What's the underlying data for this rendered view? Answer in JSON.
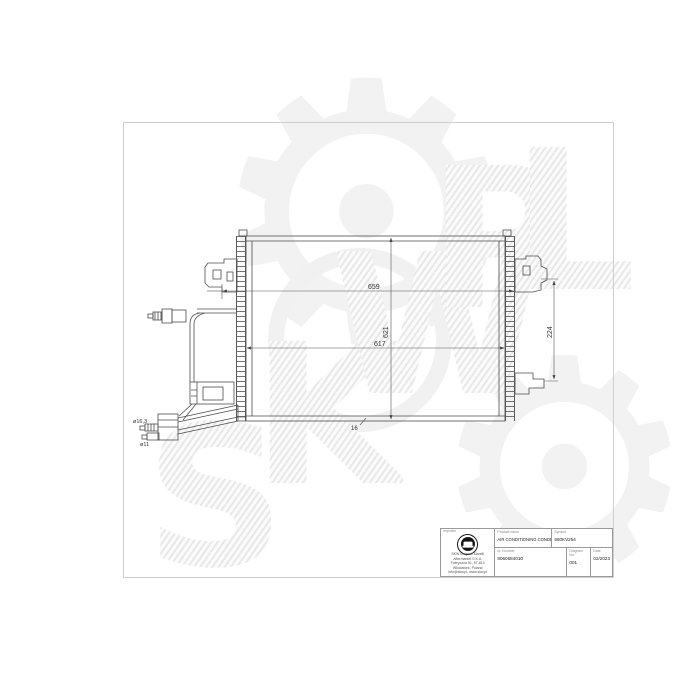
{
  "watermark": {
    "letters": [
      "S",
      "K",
      "W",
      "P",
      "L"
    ],
    "gear_glyph": "⚙"
  },
  "drawing": {
    "dim_width_total": "659",
    "dim_width_core": "617",
    "dim_height_core": "621",
    "dim_bracket_span": "224",
    "dim_depth": "16",
    "dim_port_large": "ø16,3",
    "dim_port_small": "ø11"
  },
  "title_block": {
    "producer_label": "Importer",
    "company_lines": [
      "SKW Magneti Marelli Aftermarket S.K.A.",
      "Fabryczna 51, 87-810 Włocławek, Poland",
      "info@skw.pl, www.skw.pl"
    ],
    "product_name_label": "Product name",
    "product_name": "AIR CONDITIONING CONDENSER",
    "symbol_label": "Symbol",
    "symbol": "860KV254",
    "id_number_label": "Id. Number",
    "id_number": "8060684010",
    "diagram_no_label": "Diagram No.",
    "diagram_no": "001",
    "date_label": "Date",
    "date": "02/2023"
  },
  "colors": {
    "line": "#4d4d4d",
    "dim_text": "#333333",
    "frame": "#cfcfcf",
    "watermark": "#ededed"
  }
}
